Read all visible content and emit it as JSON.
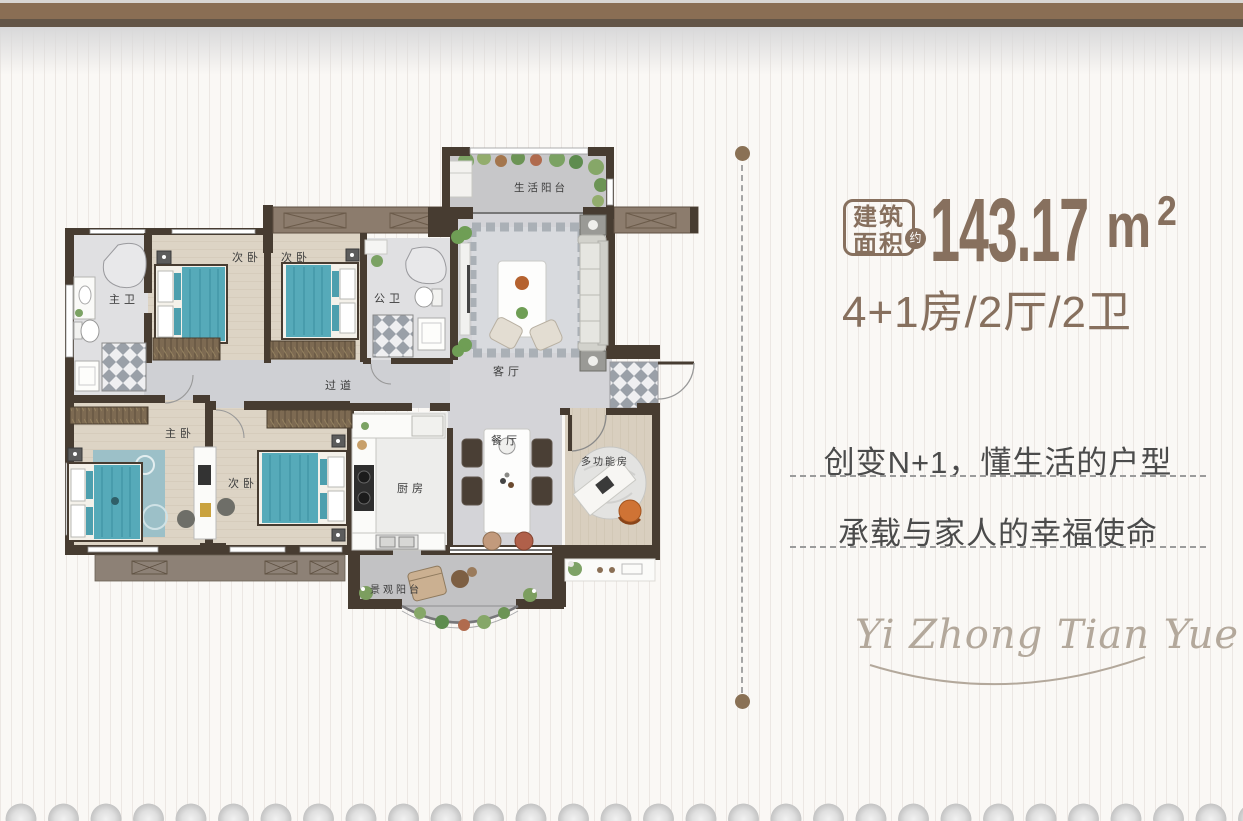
{
  "header": {
    "area_badge": {
      "line1": "建筑",
      "line2": "面积",
      "approx": "约"
    },
    "area": {
      "value": "143.17",
      "unit": "m",
      "sup": "2"
    },
    "layout_spec": "4+1房/2厅/2卫"
  },
  "taglines": {
    "line1": "创变N+1，懂生活的户型",
    "line2": "承载与家人的幸福使命"
  },
  "logo": {
    "text": "Yi Zhong Tian Yue"
  },
  "floorplan": {
    "rooms": [
      {
        "id": "life-balcony",
        "label": "生活阳台"
      },
      {
        "id": "bedroom-2",
        "label": "次卧"
      },
      {
        "id": "bedroom-3",
        "label": "次卧"
      },
      {
        "id": "master-bath",
        "label": "主卫"
      },
      {
        "id": "public-bath",
        "label": "公卫"
      },
      {
        "id": "corridor",
        "label": "过道"
      },
      {
        "id": "living-room",
        "label": "客厅"
      },
      {
        "id": "master-bedroom",
        "label": "主卧"
      },
      {
        "id": "bedroom-4",
        "label": "次卧"
      },
      {
        "id": "kitchen",
        "label": "厨房"
      },
      {
        "id": "dining-room",
        "label": "餐厅"
      },
      {
        "id": "multi-function-room",
        "label": "多功能房"
      },
      {
        "id": "view-balcony",
        "label": "景观阳台"
      }
    ]
  },
  "colors": {
    "brand_brown": "#87705e",
    "band_brown": "#8a6e54",
    "band_dark": "#635547",
    "dot_brown": "#8a7155",
    "tagline_gray": "#4b4b4b",
    "logo_taupe": "#b3a89b"
  }
}
